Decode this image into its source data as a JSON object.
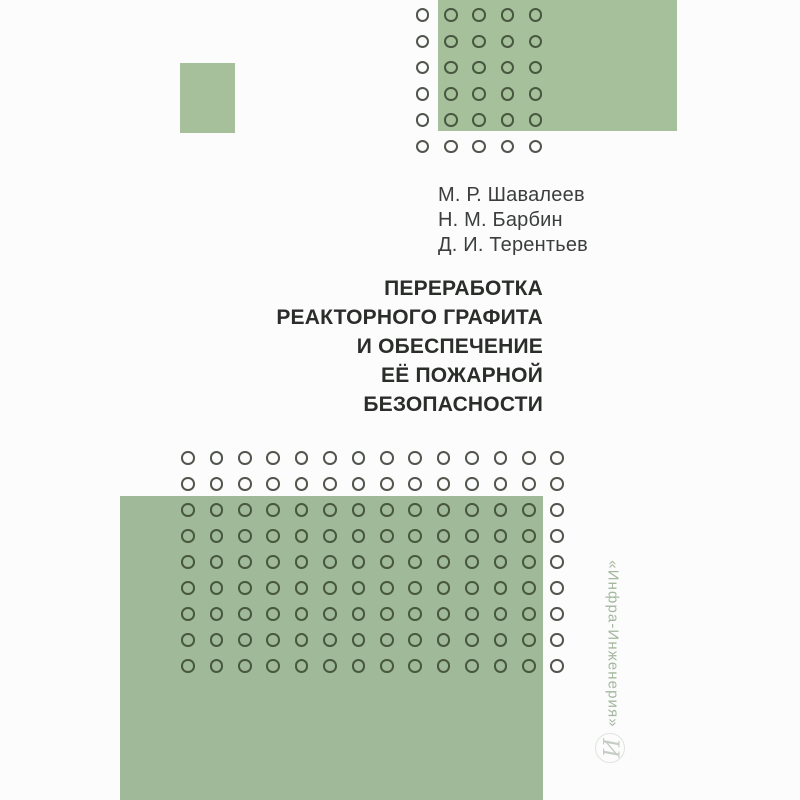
{
  "cover": {
    "authors": [
      "М. Р. Шавалеев",
      "Н. М. Барбин",
      "Д. И. Терентьев"
    ],
    "title_lines": [
      "ПЕРЕРАБОТКА",
      "РЕАКТОРНОГО ГРАФИТА",
      "И ОБЕСПЕЧЕНИЕ",
      "ЕЁ ПОЖАРНОЙ",
      "БЕЗОПАСНОСТИ"
    ],
    "publisher": "«Инфра-Инженерия»",
    "logo_glyph": "И"
  },
  "colors": {
    "background": "#fbfcfb",
    "green_top": "#a6c09c",
    "green_main": "#a0b998",
    "ring_on_white": "#52564e",
    "ring_on_green": "#47583e",
    "author_text": "#3b3e3c",
    "title_text": "#2b2d2b",
    "publisher_text": "#a4b79f",
    "logo_glyph": "#c5ccc4",
    "logo_ring": "#dfe4de"
  },
  "decor": {
    "top_grid": {
      "cols": 5,
      "rows": 6,
      "start_x": 422.7,
      "start_y": 15,
      "dx": 28.25,
      "dy": 26.3,
      "diameter": 13.5,
      "green_zone": {
        "left": 438,
        "top": 0,
        "right": 677,
        "bottom": 131
      }
    },
    "mid_grid": {
      "cols": 14,
      "rows": 9,
      "start_x": 188,
      "start_y": 458,
      "dx": 28.4,
      "dy": 26,
      "diameter": 13.5,
      "green_zone": {
        "left": 120,
        "top": 496,
        "right": 543,
        "bottom": 800
      }
    }
  }
}
